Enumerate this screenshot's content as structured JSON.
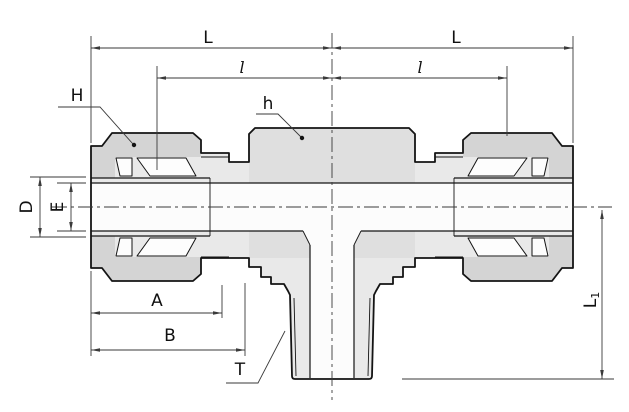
{
  "dimensions": {
    "L_left": "L",
    "L_right": "L",
    "l_left": "l",
    "l_right": "l",
    "H": "H",
    "h": "h",
    "D": "D",
    "E": "E",
    "A": "A",
    "B": "B",
    "T": "T",
    "L1": {
      "main": "L",
      "sub": "1"
    }
  },
  "colors": {
    "line": "#141414",
    "dim": "#3a3a3a",
    "body": "#e9e9e9",
    "nut": "#d4d4d4",
    "hex": "#dfdfdf",
    "bore": "#fcfcfc",
    "bg": "#ffffff"
  }
}
